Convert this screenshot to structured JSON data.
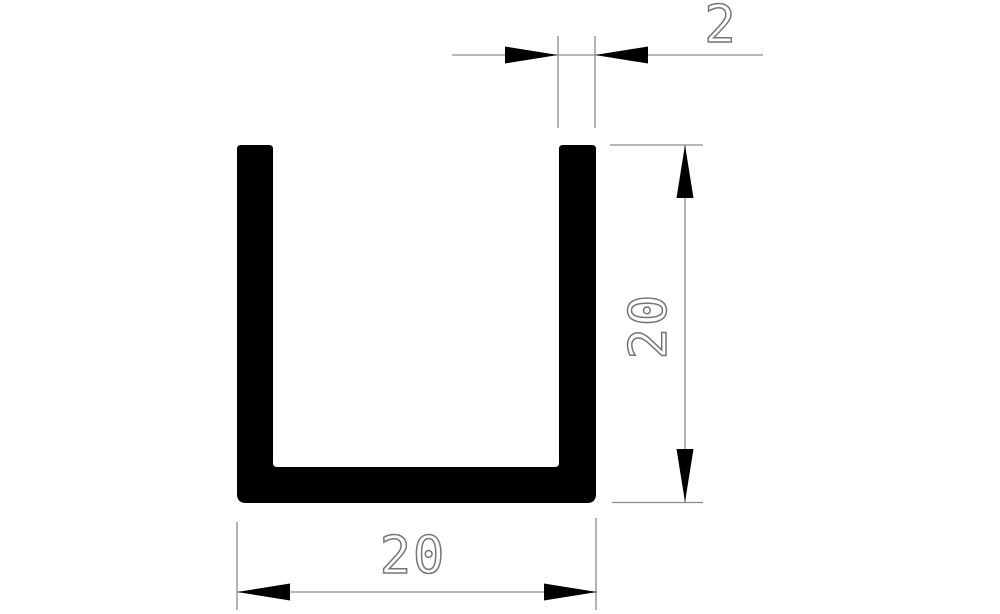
{
  "dimensions": {
    "thickness_label": "2",
    "height_label": "20",
    "width_label": "20"
  },
  "colors": {
    "background": "#ffffff",
    "profile": "#000000",
    "line": "#8c8c8c",
    "text": "#757575"
  }
}
